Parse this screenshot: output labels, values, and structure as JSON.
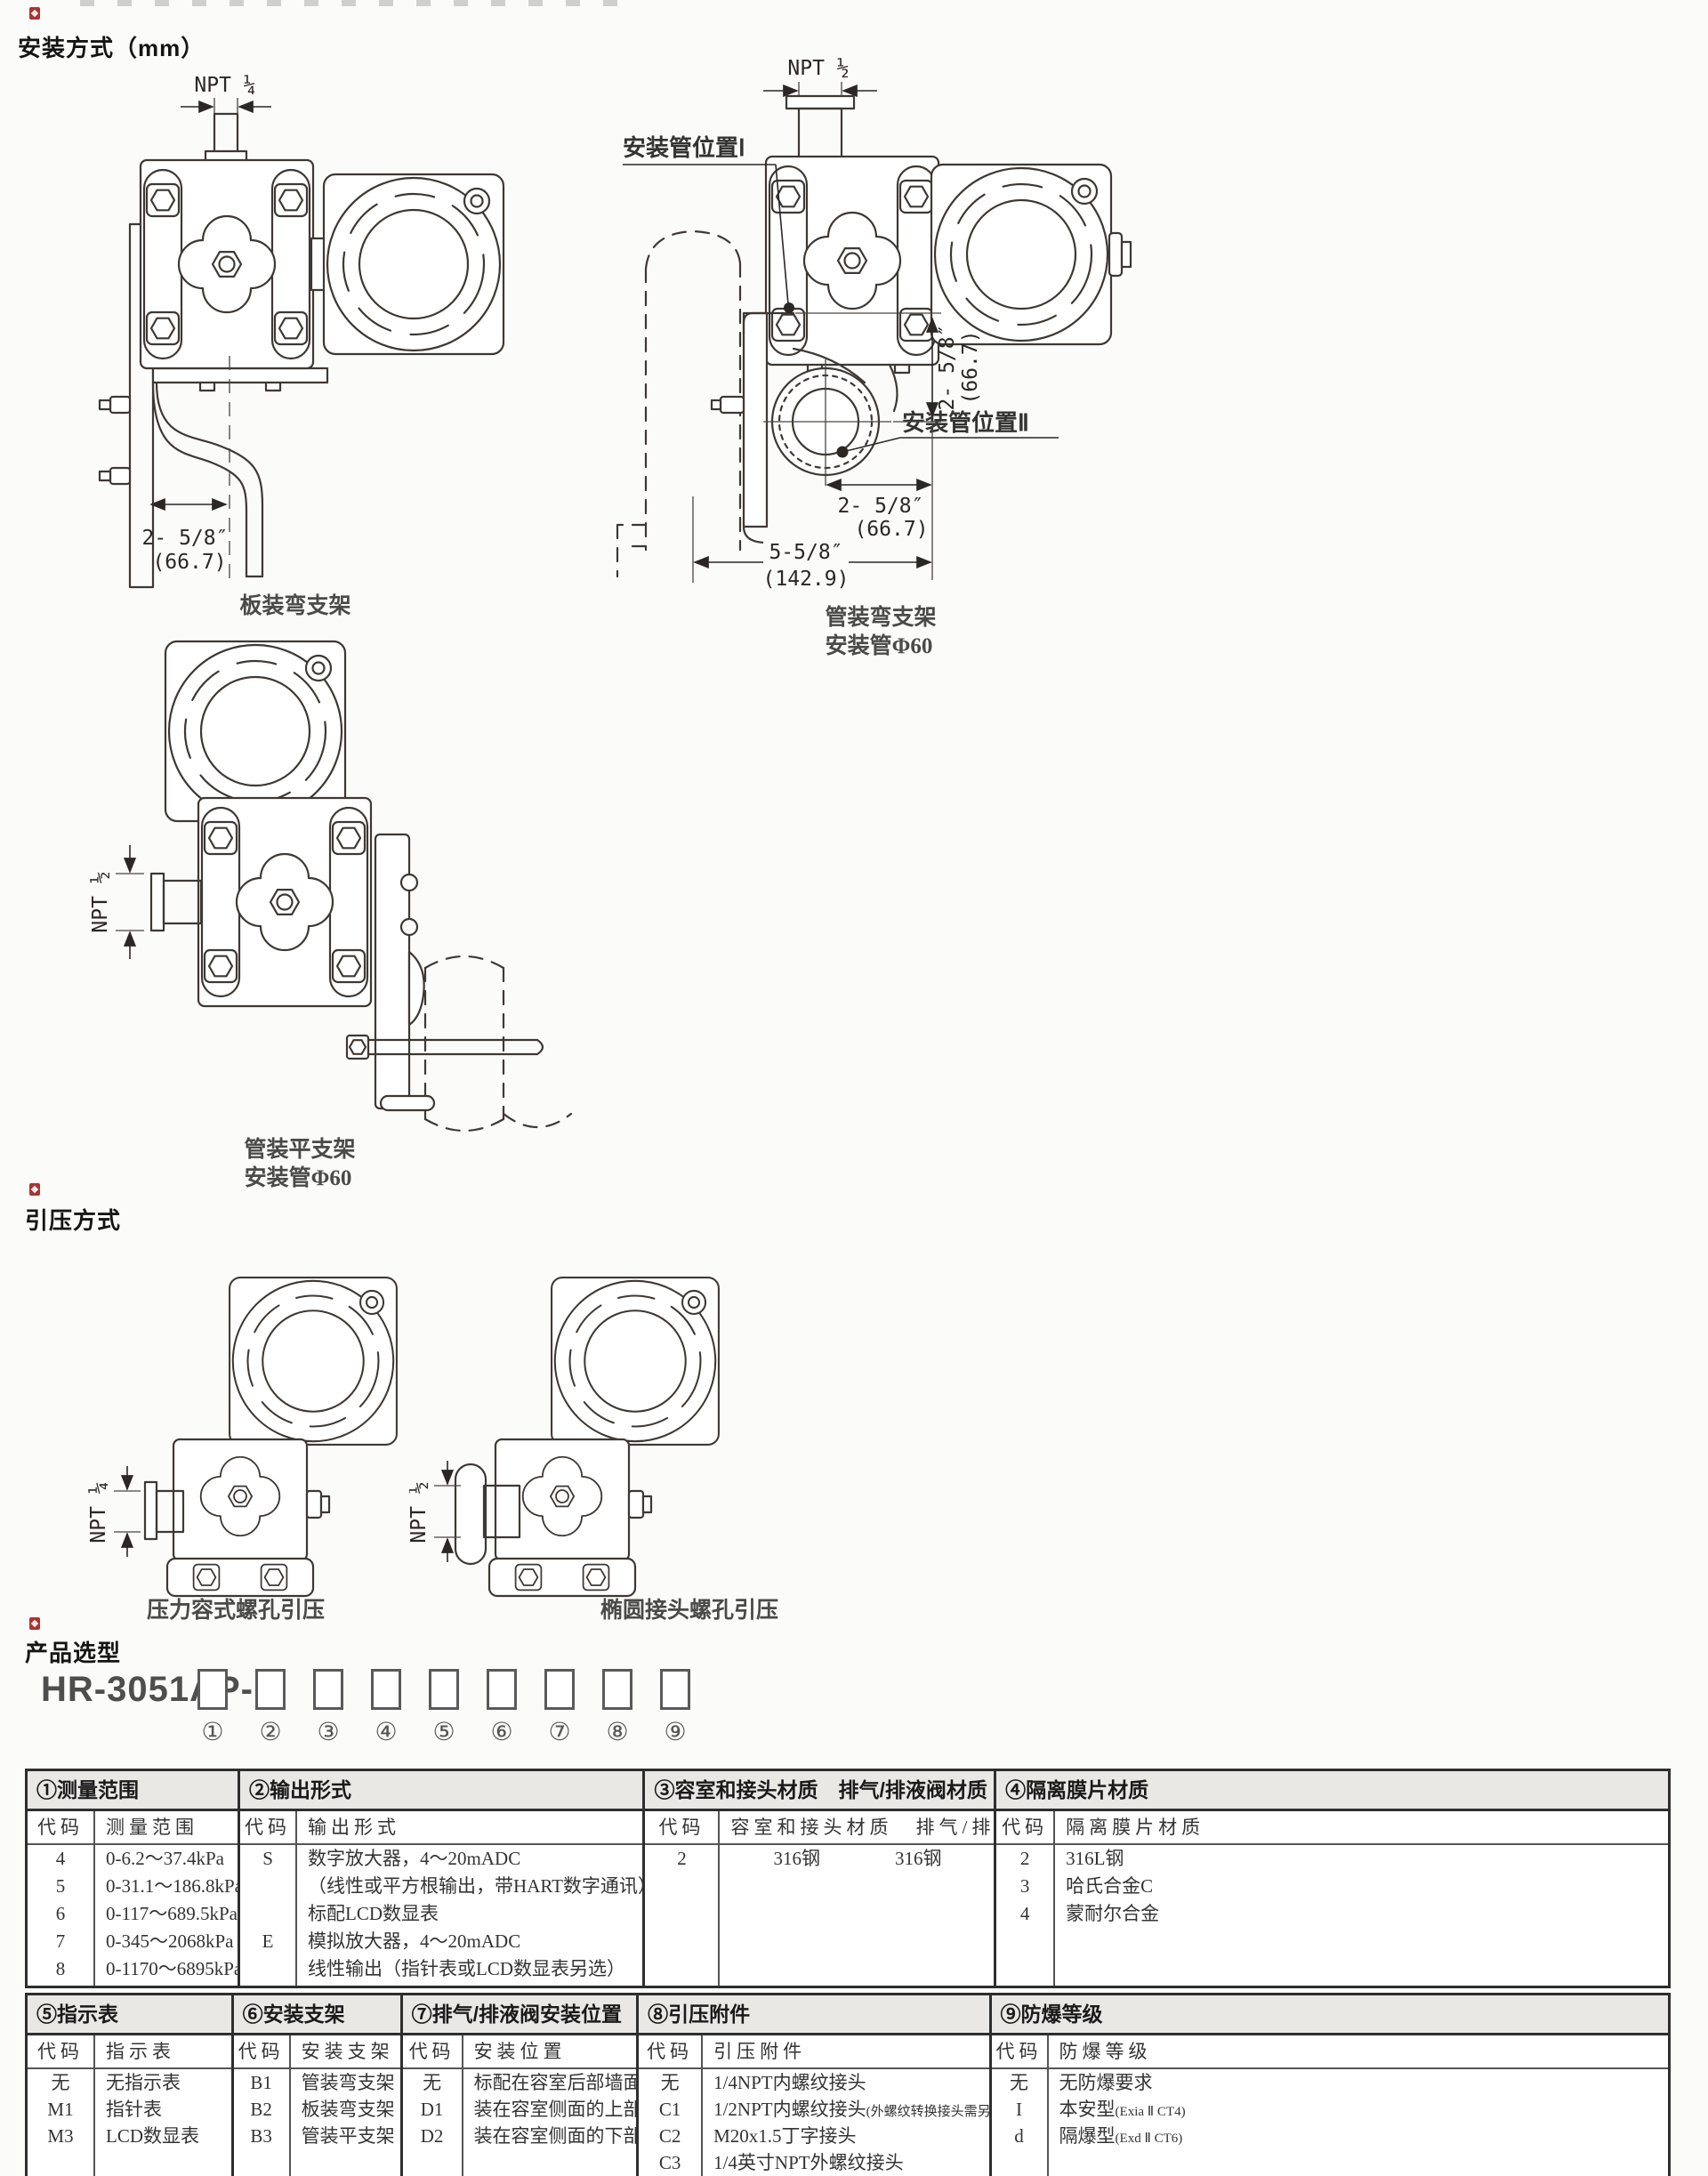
{
  "sections": {
    "mounting": {
      "title": "安装方式（mm）",
      "panel": {
        "npt": "NPT ¼",
        "dim1": "2- 5/8″",
        "dim2": "(66.7)",
        "caption": "板装弯支架"
      },
      "pipe_bent": {
        "npt": "NPT ½",
        "pos1": "安装管位置Ⅰ",
        "pos2": "安装管位置Ⅱ",
        "vdim1": "2- 5/8″",
        "vdim2": "(66.7)",
        "hdim1a": "2- 5/8″",
        "hdim1b": "(66.7)",
        "hdim2a": "5-5/8″",
        "hdim2b": "(142.9)",
        "caption1": "管装弯支架",
        "caption2": "安装管Φ60"
      },
      "pipe_flat": {
        "npt": "NPT ½",
        "caption1": "管装平支架",
        "caption2": "安装管Φ60"
      }
    },
    "pressure_intro": {
      "title": "引压方式",
      "chamber": {
        "npt": "NPT ¼",
        "caption": "压力容式螺孔引压"
      },
      "oval": {
        "npt": "NPT ½",
        "caption": "椭圆接头螺孔引压"
      }
    },
    "selection": {
      "title": "产品选型",
      "model_prefix": "HR-3051AP-",
      "positions": [
        "①",
        "②",
        "③",
        "④",
        "⑤",
        "⑥",
        "⑦",
        "⑧",
        "⑨"
      ],
      "table1": {
        "columns": [
          {
            "title": "①测量范围",
            "ch": "代码",
            "vh": "测量范围",
            "rows": [
              [
                "4",
                "0-6.2～37.4kPa"
              ],
              [
                "5",
                "0-31.1～186.8kPa"
              ],
              [
                "6",
                "0-117～689.5kPa"
              ],
              [
                "7",
                "0-345～2068kPa"
              ],
              [
                "8",
                "0-1170～6895kPa"
              ]
            ]
          },
          {
            "title": "②输出形式",
            "ch": "代码",
            "vh": "输出形式",
            "rows": [
              [
                "S",
                "数字放大器，4～20mADC"
              ],
              [
                "",
                "（线性或平方根输出，带HART数字通讯）"
              ],
              [
                "",
                "标配LCD数显表"
              ],
              [
                "E",
                "模拟放大器，4～20mADC"
              ],
              [
                "",
                "线性输出（指针表或LCD数显表另选）"
              ]
            ]
          },
          {
            "title": "③容室和接头材质　排气/排液阀材质",
            "ch": "代码",
            "vh": "容室和接头材质　排气/排液阀材质",
            "rows": [
              [
                "2",
                "316钢　　　　316钢"
              ]
            ]
          },
          {
            "title": "④隔离膜片材质",
            "ch": "代码",
            "vh": "隔离膜片材质",
            "rows": [
              [
                "2",
                "316L钢"
              ],
              [
                "3",
                "哈氏合金C"
              ],
              [
                "4",
                "蒙耐尔合金"
              ]
            ]
          }
        ]
      },
      "table2": {
        "columns": [
          {
            "title": "⑤指示表",
            "ch": "代码",
            "vh": "指示表",
            "rows": [
              [
                "无",
                "无指示表"
              ],
              [
                "M1",
                "指针表"
              ],
              [
                "M3",
                "LCD数显表"
              ]
            ]
          },
          {
            "title": "⑥安装支架",
            "ch": "代码",
            "vh": "安装支架",
            "rows": [
              [
                "B1",
                "管装弯支架"
              ],
              [
                "B2",
                "板装弯支架"
              ],
              [
                "B3",
                "管装平支架"
              ]
            ]
          },
          {
            "title": "⑦排气/排液阀安装位置",
            "ch": "代码",
            "vh": "安装位置",
            "rows": [
              [
                "无",
                "标配在容室后部墙面"
              ],
              [
                "D1",
                "装在容室侧面的上部"
              ],
              [
                "D2",
                "装在容室侧面的下部"
              ]
            ]
          },
          {
            "title": "⑧引压附件",
            "ch": "代码",
            "vh": "引压附件",
            "rows": [
              [
                "无",
                "1/4NPT内螺纹接头",
                ""
              ],
              [
                "C1",
                "1/2NPT内螺纹接头",
                "(外螺纹转换接头需另买)"
              ],
              [
                "C2",
                "M20x1.5丁字接头",
                ""
              ],
              [
                "C3",
                "1/4英寸NPT外螺纹接头",
                ""
              ]
            ]
          },
          {
            "title": "⑨防爆等级",
            "ch": "代码",
            "vh": "防爆等级",
            "rows": [
              [
                "无",
                "无防爆要求",
                ""
              ],
              [
                "I",
                "本安型",
                "(Exia Ⅱ CT4)"
              ],
              [
                "d",
                "隔爆型",
                "(Exd Ⅱ CT6)"
              ]
            ]
          }
        ]
      }
    }
  }
}
